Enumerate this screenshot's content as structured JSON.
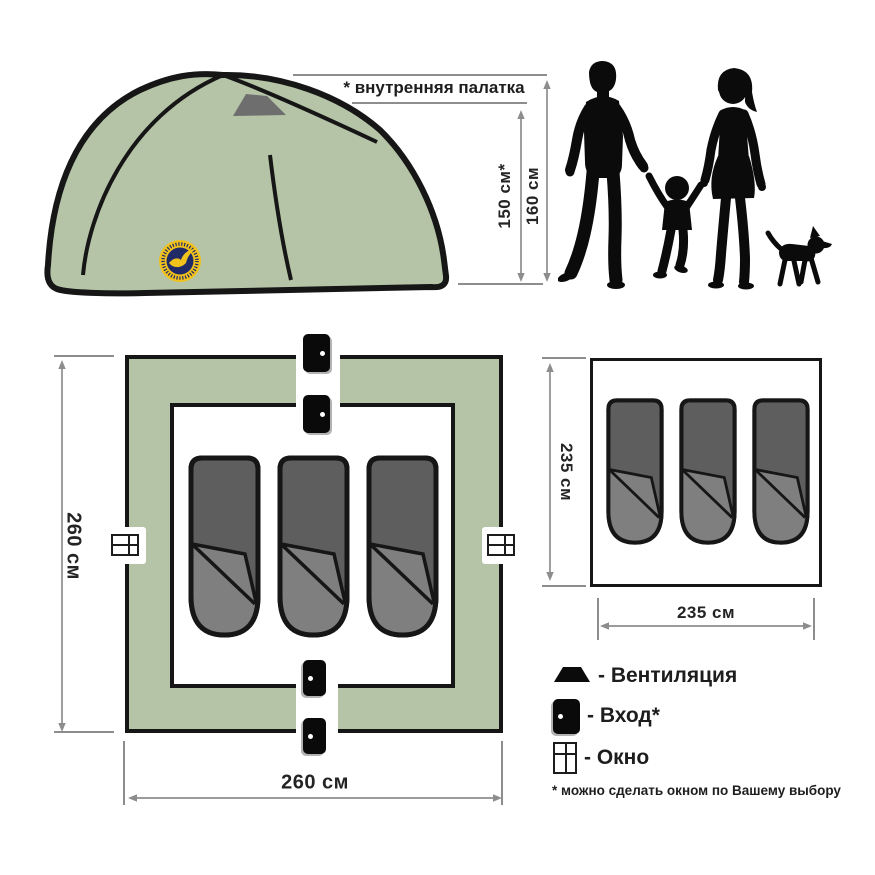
{
  "annotations": {
    "inner_tent_note": "* внутренняя палатка",
    "inner_height": "150 см*",
    "outer_height": "160 см"
  },
  "outer_plan": {
    "height_label": "260 см",
    "width_label": "260 см",
    "sleeping_bag_count": 3
  },
  "inner_plan": {
    "height_label": "235 см",
    "width_label": "235 см",
    "sleeping_bag_count": 3
  },
  "legend": {
    "items": [
      {
        "icon": "vent-icon",
        "label": "- Вентиляция"
      },
      {
        "icon": "door-icon",
        "label": "- Вход*"
      },
      {
        "icon": "window-icon",
        "label": "- Окно"
      }
    ],
    "footnote": "* можно сделать окном по Вашему выбору"
  },
  "colors": {
    "tent_green": "#b5c4a6",
    "outline_black": "#161616",
    "sleeping_bag_dark": "#5e5e5e",
    "sleeping_bag_light": "#7f7f7f",
    "vent_gray": "#6e6e6e",
    "dimension_gray": "#8d8d8d",
    "logo_navy": "#1f2a66",
    "logo_yellow": "#f2c21c"
  }
}
